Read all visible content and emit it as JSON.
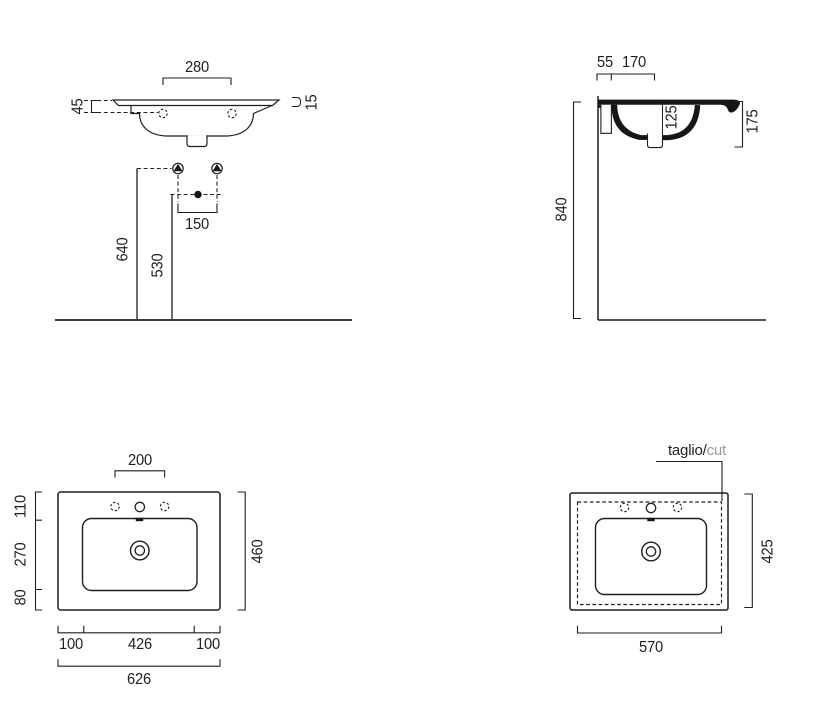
{
  "drawing": {
    "front": {
      "d280": "280",
      "d45": "45",
      "d15": "15",
      "d150": "150",
      "d640": "640",
      "d530": "530"
    },
    "side": {
      "d55": "55",
      "d170": "170",
      "d125": "125",
      "d175": "175",
      "d840": "840"
    },
    "plan": {
      "d200": "200",
      "d110": "110",
      "d270": "270",
      "d80": "80",
      "d460": "460",
      "d100_left": "100",
      "d426": "426",
      "d100_right": "100",
      "d626": "626"
    },
    "cut": {
      "label_it": "taglio/",
      "label_en": "cut",
      "d425": "425",
      "d570": "570"
    }
  },
  "colors": {
    "line": "#1f1f1f",
    "fill_section": "#161616",
    "cut_label_muted": "#9a9a9a"
  }
}
